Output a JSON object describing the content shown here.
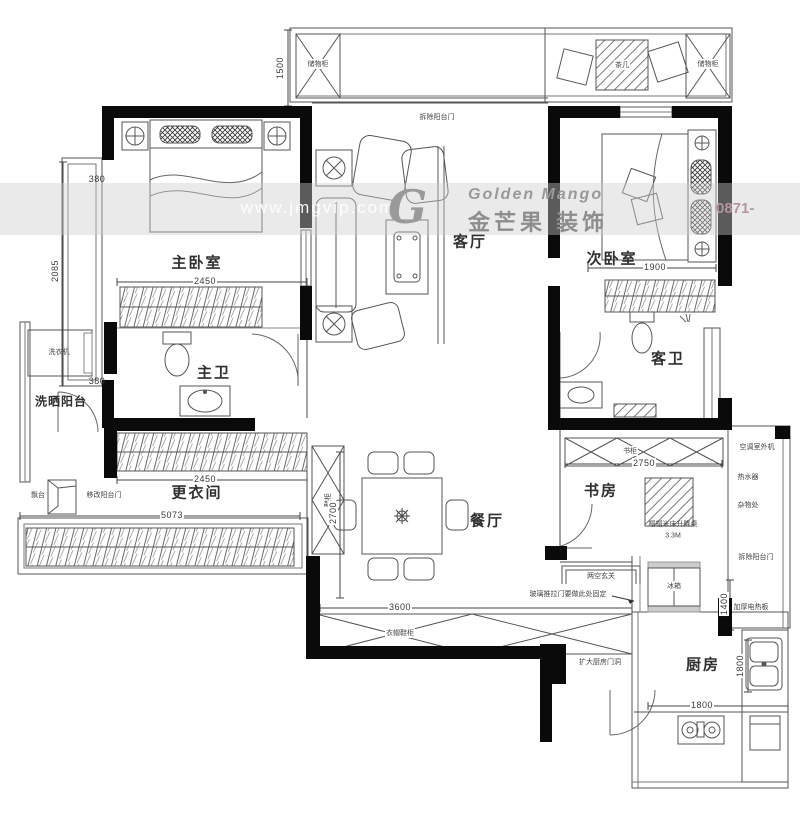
{
  "watermark": {
    "brand_en": "Golden Mango",
    "brand_cn": "金芒果 装饰",
    "url": "www.jmgvip.com",
    "phone": "0871-",
    "logo_letter": "G"
  },
  "rooms": {
    "master_bedroom": "主卧室",
    "second_bedroom": "次卧室",
    "living_room": "客厅",
    "dining_room": "餐厅",
    "master_bath": "主卫",
    "guest_bath": "客卫",
    "laundry_balcony": "洗晒阳台",
    "dressing_room": "更衣间",
    "study": "书房",
    "kitchen": "厨房"
  },
  "annotations": {
    "demolish_balcony_door_top": "拆除阳台门",
    "storage_cabinet_left": "储物柜",
    "storage_cabinet_right": "储物柜",
    "tea_table": "茶几",
    "washing_machine": "洗衣机",
    "bay_ledge": "飘台",
    "move_balcony_door": "移改阳台门",
    "shoe_cabinet": "鞋柜",
    "coat_shoe_cabinet": "衣帽鞋柜",
    "bookcase": "书柜",
    "tatami_desk": "榻榻米床升降桌",
    "tatami_area": "3.3M",
    "ac_outdoor_unit": "空调室外机",
    "water_heater": "热水器",
    "sundry_area": "杂物处",
    "demolish_balcony_door_right": "拆除阳台门",
    "entry_cabinet": "两空玄关",
    "glass_sliding_door_note": "玻璃推拉门要做此处固定",
    "fridge": "冰箱",
    "enlarge_kitchen_doorway": "扩大厨房门洞",
    "electric_heater": "加厚电热板"
  },
  "dimensions": {
    "balcony_depth": "1500",
    "bay_top": "380",
    "bay_height": "2085",
    "bay_bottom": "380",
    "master_width": "2450",
    "dressing_width": "2450",
    "left_total": "5073",
    "dining_depth": "2700",
    "dining_width": "3600",
    "second_width": "1900",
    "study_width": "2750",
    "kitchen_top": "1400",
    "kitchen_sink_run": "1800",
    "kitchen_width": "1800"
  },
  "colors": {
    "wall": "#0a0a0a",
    "line": "#555555",
    "watermark_text": "#9a9a9a",
    "phone": "#b3969d"
  }
}
